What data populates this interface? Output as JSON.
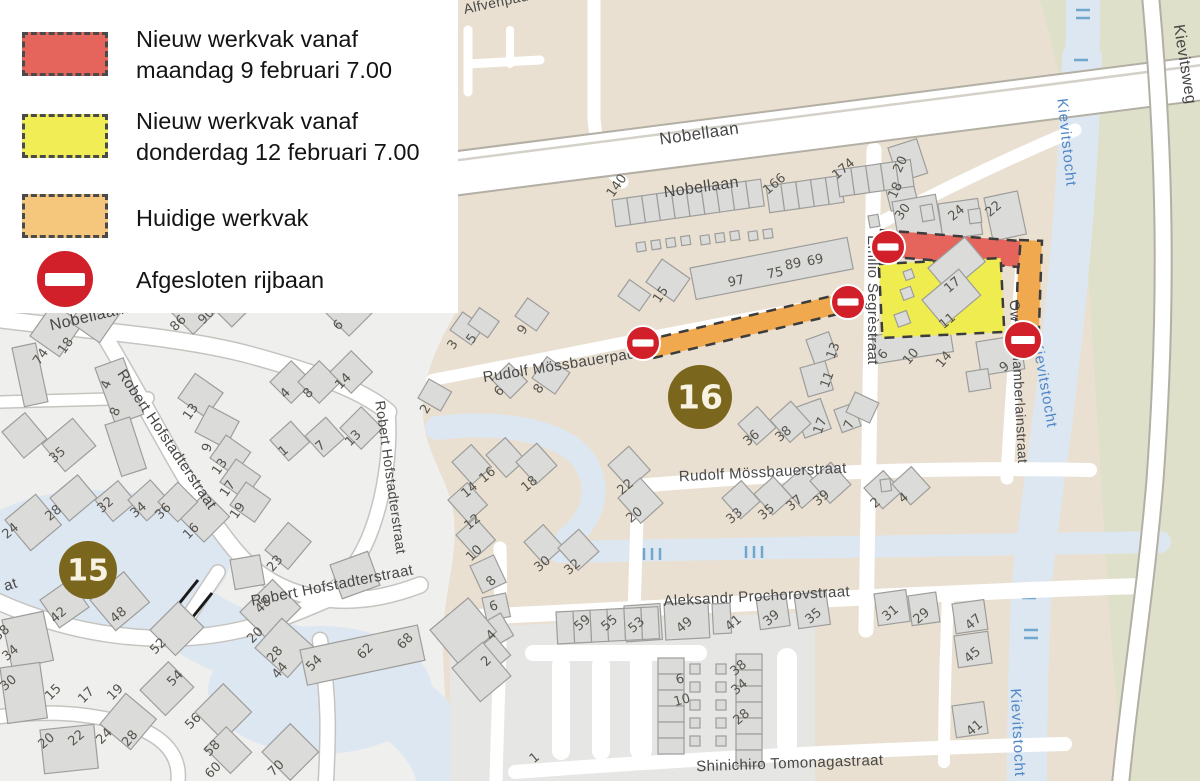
{
  "legend": {
    "items": [
      {
        "id": "new-work-feb9",
        "swatch": "red",
        "line1": "Nieuw werkvak vanaf",
        "line2": "maandag 9 februari 7.00"
      },
      {
        "id": "new-work-feb12",
        "swatch": "yellow",
        "line1": "Nieuw werkvak vanaf",
        "line2": "donderdag 12 februari 7.00"
      },
      {
        "id": "current-work",
        "swatch": "orange",
        "line1": "Huidige werkvak",
        "line2": ""
      },
      {
        "id": "closed-road",
        "swatch": "no-entry-sign",
        "line1": "Afgesloten rijbaan",
        "line2": ""
      }
    ]
  },
  "map": {
    "colors": {
      "work_red": "#e5655c",
      "work_yellow": "#efec4f",
      "work_orange": "#f0a94f",
      "legend_red": "#e5655c",
      "legend_yellow": "#f1ee55",
      "legend_orange": "#f4c77d",
      "no_entry": "#d2202a",
      "badge": "#7b661d",
      "beige": "#e9e0d1",
      "light": "#efefed",
      "water": "#dde7f2",
      "green": "#dee0c9",
      "road": "#ffffff"
    },
    "badges": [
      {
        "n": "15",
        "x": 88,
        "y": 570,
        "r": 29
      },
      {
        "n": "16",
        "x": 700,
        "y": 397,
        "r": 32
      }
    ],
    "no_entry_signs": [
      {
        "x": 888,
        "y": 247,
        "r": 17
      },
      {
        "x": 848,
        "y": 302,
        "r": 17
      },
      {
        "x": 643,
        "y": 343,
        "r": 17
      },
      {
        "x": 1023,
        "y": 340,
        "r": 19
      }
    ],
    "street_labels": [
      {
        "t": "Alfvenpad",
        "x": 497,
        "y": 7,
        "r": -12,
        "k": "road",
        "s": 14
      },
      {
        "t": "Nobellaan",
        "x": 700,
        "y": 139,
        "r": -8,
        "k": "road",
        "s": 17
      },
      {
        "t": "Nobellaan",
        "x": 702,
        "y": 192,
        "r": -8,
        "k": "road",
        "s": 16
      },
      {
        "t": "Nobellaan",
        "x": 88,
        "y": 322,
        "r": -13,
        "k": "road",
        "s": 16
      },
      {
        "t": "Kievitsweg",
        "x": 1180,
        "y": 65,
        "r": 81,
        "k": "road",
        "s": 16
      },
      {
        "t": "Kievitstocht",
        "x": 1062,
        "y": 143,
        "r": 84,
        "k": "water",
        "s": 15
      },
      {
        "t": "Kievitstocht",
        "x": 1040,
        "y": 385,
        "r": 80,
        "k": "water",
        "s": 15
      },
      {
        "t": "Kievitstocht",
        "x": 1013,
        "y": 733,
        "r": 87,
        "k": "water",
        "s": 15
      },
      {
        "t": "Emilio Segrèstraat",
        "x": 868,
        "y": 300,
        "r": 90,
        "k": "road",
        "s": 15
      },
      {
        "t": "Owen Chamberlainstraat",
        "x": 1014,
        "y": 382,
        "r": 87,
        "k": "road",
        "s": 14
      },
      {
        "t": "Rudolf Mössbauerpad",
        "x": 560,
        "y": 370,
        "r": -9,
        "k": "road",
        "s": 15
      },
      {
        "t": "Rudolf Mössbauerstraat",
        "x": 763,
        "y": 477,
        "r": -3,
        "k": "road",
        "s": 15
      },
      {
        "t": "Aleksandr Prochorovstraat",
        "x": 757,
        "y": 601,
        "r": -3,
        "k": "road",
        "s": 15
      },
      {
        "t": "Shinichiro Tomonagastraat",
        "x": 790,
        "y": 768,
        "r": -2,
        "k": "road",
        "s": 15
      },
      {
        "t": "Robert Hofstadterstraat",
        "x": 163,
        "y": 442,
        "r": 56,
        "k": "road",
        "s": 15
      },
      {
        "t": "Robert Hofstadterstraat",
        "x": 386,
        "y": 478,
        "r": 82,
        "k": "road",
        "s": 14
      },
      {
        "t": "Robert Hofstadterstraat",
        "x": 333,
        "y": 590,
        "r": -11,
        "k": "road",
        "s": 15
      },
      {
        "t": "at",
        "x": 12,
        "y": 589,
        "r": -18,
        "k": "road",
        "s": 15
      }
    ],
    "house_numbers": [
      [
        "140",
        620,
        188,
        -55
      ],
      [
        "166",
        777,
        187,
        -40
      ],
      [
        "174",
        846,
        172,
        -40
      ],
      [
        "97",
        737,
        285,
        -12
      ],
      [
        "75",
        776,
        277,
        -12
      ],
      [
        "89",
        794,
        268,
        -12
      ],
      [
        "69",
        816,
        264,
        -12
      ],
      [
        "15",
        664,
        297,
        -55
      ],
      [
        "20",
        904,
        166,
        -65
      ],
      [
        "18",
        899,
        192,
        -65
      ],
      [
        "30",
        906,
        214,
        -55
      ],
      [
        "24",
        959,
        216,
        -40
      ],
      [
        "22",
        996,
        212,
        -40
      ],
      [
        "17",
        955,
        288,
        -40
      ],
      [
        "11",
        950,
        324,
        -40
      ],
      [
        "6",
        886,
        357,
        -50
      ],
      [
        "10",
        914,
        359,
        -50
      ],
      [
        "14",
        947,
        362,
        -50
      ],
      [
        "9",
        1007,
        370,
        -40
      ],
      [
        "3",
        456,
        347,
        -55
      ],
      [
        "5",
        475,
        341,
        -55
      ],
      [
        "9",
        526,
        332,
        -55
      ],
      [
        "2",
        429,
        411,
        -60
      ],
      [
        "6",
        502,
        394,
        -45
      ],
      [
        "8",
        542,
        391,
        -55
      ],
      [
        "13",
        837,
        352,
        -70
      ],
      [
        "11",
        831,
        381,
        -70
      ],
      [
        "17",
        824,
        427,
        -70
      ],
      [
        "7",
        853,
        426,
        -70
      ],
      [
        "36",
        754,
        441,
        -40
      ],
      [
        "38",
        786,
        437,
        -40
      ],
      [
        "33",
        737,
        519,
        -40
      ],
      [
        "35",
        769,
        515,
        -40
      ],
      [
        "37",
        797,
        506,
        -40
      ],
      [
        "39",
        824,
        501,
        -40
      ],
      [
        "2",
        878,
        506,
        -40
      ],
      [
        "4",
        906,
        501,
        -40
      ],
      [
        "16",
        490,
        478,
        -40
      ],
      [
        "18",
        532,
        487,
        -40
      ],
      [
        "14",
        472,
        493,
        -40
      ],
      [
        "12",
        475,
        525,
        -40
      ],
      [
        "22",
        628,
        490,
        -40
      ],
      [
        "20",
        637,
        518,
        -40
      ],
      [
        "30",
        545,
        567,
        -40
      ],
      [
        "32",
        575,
        570,
        -40
      ],
      [
        "10",
        477,
        556,
        -45
      ],
      [
        "8",
        494,
        584,
        -45
      ],
      [
        "6",
        495,
        610,
        -20
      ],
      [
        "4",
        494,
        638,
        -45
      ],
      [
        "2",
        489,
        664,
        -45
      ],
      [
        "59",
        585,
        626,
        -40
      ],
      [
        "55",
        612,
        626,
        -40
      ],
      [
        "53",
        639,
        628,
        -40
      ],
      [
        "49",
        687,
        628,
        -40
      ],
      [
        "41",
        736,
        626,
        -40
      ],
      [
        "39",
        774,
        621,
        -40
      ],
      [
        "35",
        816,
        619,
        -40
      ],
      [
        "31",
        893,
        616,
        -40
      ],
      [
        "29",
        924,
        619,
        -40
      ],
      [
        "47",
        976,
        625,
        -40
      ],
      [
        "45",
        975,
        658,
        -40
      ],
      [
        "41",
        977,
        731,
        -40
      ],
      [
        "6",
        681,
        683,
        -15
      ],
      [
        "10",
        683,
        704,
        -15
      ],
      [
        "38",
        741,
        671,
        -40
      ],
      [
        "34",
        742,
        690,
        -40
      ],
      [
        "28",
        744,
        720,
        -40
      ],
      [
        "1",
        537,
        761,
        -40
      ],
      [
        "74",
        44,
        359,
        -55
      ],
      [
        "18",
        69,
        348,
        -55
      ],
      [
        "86",
        181,
        326,
        -45
      ],
      [
        "90",
        209,
        319,
        -45
      ],
      [
        "6",
        341,
        328,
        -45
      ],
      [
        "4",
        110,
        386,
        -70
      ],
      [
        "8",
        119,
        413,
        -70
      ],
      [
        "35",
        60,
        458,
        -40
      ],
      [
        "13",
        194,
        414,
        -55
      ],
      [
        "9",
        211,
        449,
        -70
      ],
      [
        "13",
        223,
        469,
        -55
      ],
      [
        "17",
        231,
        491,
        -55
      ],
      [
        "19",
        241,
        513,
        -55
      ],
      [
        "4",
        288,
        396,
        -45
      ],
      [
        "8",
        311,
        396,
        -45
      ],
      [
        "14",
        346,
        384,
        -45
      ],
      [
        "1",
        286,
        454,
        -40
      ],
      [
        "7",
        323,
        449,
        -40
      ],
      [
        "13",
        356,
        441,
        -45
      ],
      [
        "28",
        56,
        516,
        -40
      ],
      [
        "32",
        108,
        508,
        -40
      ],
      [
        "34",
        141,
        513,
        -40
      ],
      [
        "36",
        166,
        514,
        -45
      ],
      [
        "24",
        13,
        534,
        -40
      ],
      [
        "16",
        194,
        534,
        -45
      ],
      [
        "23",
        278,
        566,
        -50
      ],
      [
        "42",
        61,
        618,
        -40
      ],
      [
        "48",
        121,
        618,
        -40
      ],
      [
        "38",
        4,
        636,
        -40
      ],
      [
        "34",
        13,
        656,
        -40
      ],
      [
        "30",
        11,
        686,
        -40
      ],
      [
        "52",
        161,
        649,
        -45
      ],
      [
        "54",
        178,
        681,
        -45
      ],
      [
        "48",
        266,
        608,
        -45
      ],
      [
        "20",
        258,
        638,
        -45
      ],
      [
        "28",
        278,
        657,
        -50
      ],
      [
        "44",
        283,
        673,
        -50
      ],
      [
        "15",
        56,
        695,
        -45
      ],
      [
        "17",
        89,
        698,
        -45
      ],
      [
        "19",
        118,
        695,
        -45
      ],
      [
        "54",
        317,
        666,
        -45
      ],
      [
        "62",
        368,
        654,
        -45
      ],
      [
        "68",
        408,
        644,
        -45
      ],
      [
        "20",
        49,
        744,
        -40
      ],
      [
        "22",
        79,
        741,
        -40
      ],
      [
        "24",
        107,
        739,
        -45
      ],
      [
        "28",
        133,
        741,
        -50
      ],
      [
        "56",
        196,
        724,
        -45
      ],
      [
        "58",
        215,
        751,
        -45
      ],
      [
        "60",
        216,
        773,
        -45
      ],
      [
        "70",
        279,
        771,
        -45
      ]
    ]
  }
}
